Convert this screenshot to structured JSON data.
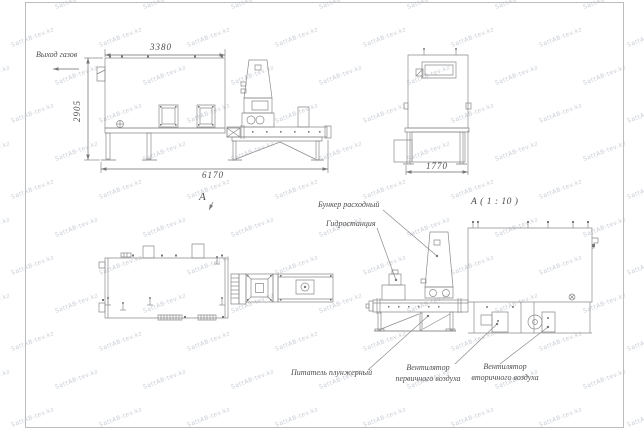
{
  "page": {
    "background": "#ffffff",
    "frame_color": "#bdbdbd",
    "line_color": "#8a8a8a",
    "text_color": "#4c4c4c"
  },
  "watermark": {
    "text": "SattAB-tev.kz"
  },
  "drawing": {
    "side_view": {
      "gas_outlet_label": "Выход газов",
      "dim_top": "3380",
      "dim_left": "2905",
      "dim_bottom": "6170",
      "view_arrow_label": "А"
    },
    "end_view": {
      "dim_bottom": "1770"
    },
    "detail_view": {
      "title": "А ( 1 : 10 )",
      "label_hopper": "Бункер расходный",
      "label_hydraulic": "Гидростанция",
      "label_feeder": "Питатель плунжерный",
      "label_primary_fan": "Вентилятор первичного воздуха",
      "label_secondary_fan": "Вентилятор вторичного воздуха"
    }
  }
}
